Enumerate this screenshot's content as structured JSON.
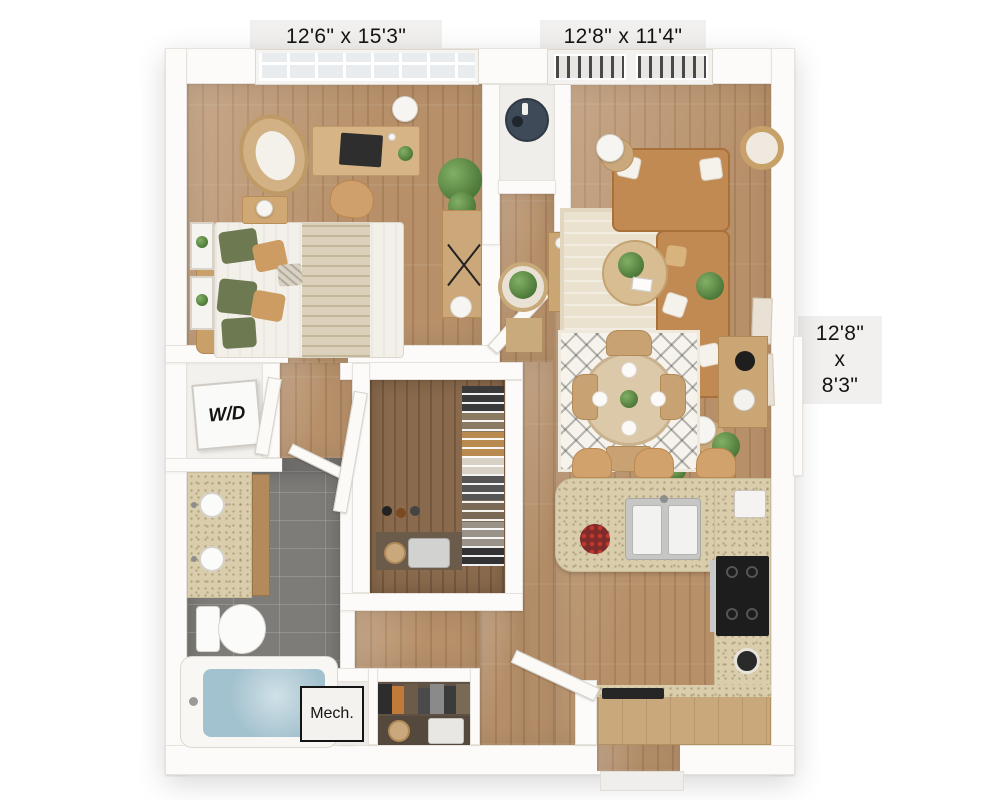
{
  "labels": {
    "bedroom_dims": "12'6\" x 15'3\"",
    "living_dims": "12'8\" x 11'4\"",
    "nook_dims": [
      "12'8\"",
      "x",
      "8'3\""
    ],
    "washer_dryer": "W/D",
    "mechanical": "Mech."
  },
  "colors": {
    "background": "#ffffff",
    "wall": "#fcfbf9",
    "wood_floor": "#b7906a",
    "closet_wood_floor": "#8a6a4c",
    "bathroom_tile": "#7d7c79",
    "granite_counter": "#d9cdab",
    "cabinet_wood": "#c9a97c",
    "sofa_leather": "#c18a52",
    "bed_linen": "#f3f0ea",
    "pillow_green": "#6d7950",
    "pillow_tan": "#cc9c63",
    "tub_water": "#a3c2cf",
    "range_black": "#1d1d1d",
    "label_bg": "#f1f0ee",
    "label_text": "#141414"
  }
}
